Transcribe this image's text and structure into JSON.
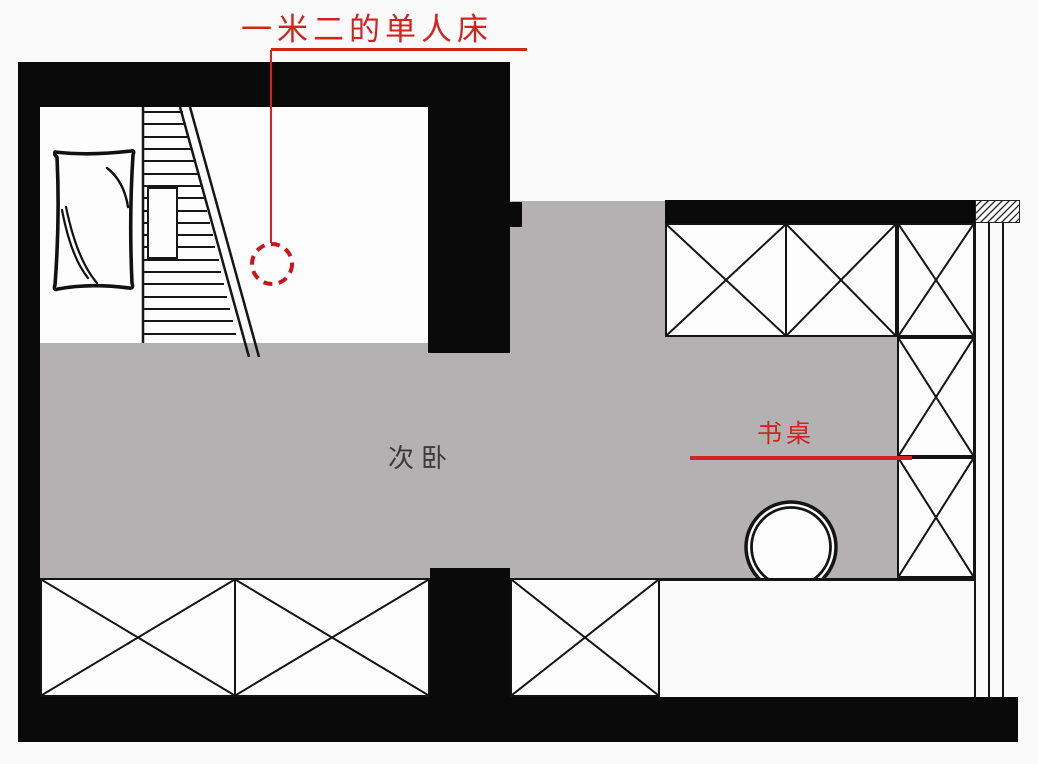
{
  "room": {
    "label": "次卧"
  },
  "annotations": {
    "bed": {
      "label": "一米二的单人床"
    },
    "desk": {
      "label": "书桌"
    }
  },
  "colors": {
    "wall_black": "#0a0a0a",
    "floor_gray": "#b3b1b2",
    "annotation_red": "#d2241f",
    "dashed_circle_red": "#c8161c",
    "furniture_line": "#161616",
    "background": "#fbfafa"
  },
  "symbols": {
    "crossed_box": "wardrobe-cabinet",
    "double_circle": "stool",
    "dashed_circle": "bed-position-marker",
    "hatched_rect": "wall-section",
    "triple_vertical_lines": "window"
  }
}
